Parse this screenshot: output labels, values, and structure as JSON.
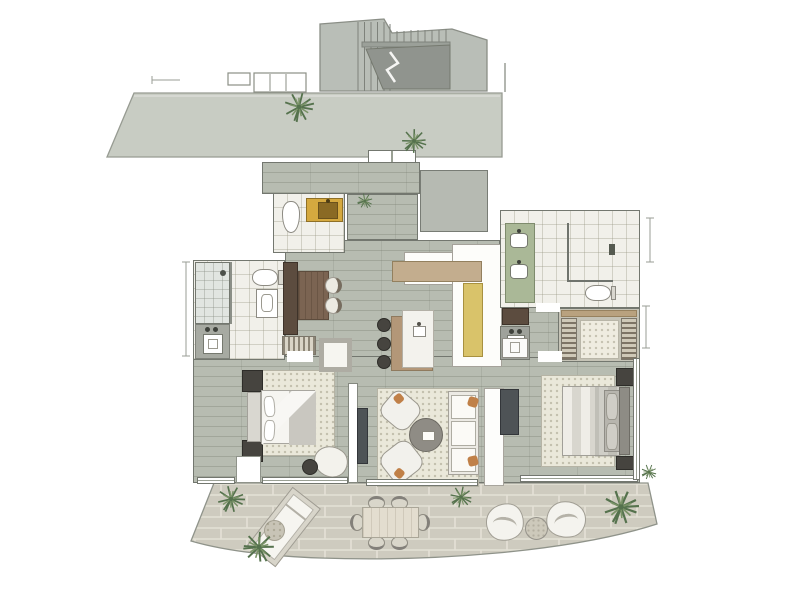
{
  "palette": {
    "bg": "#ffffff",
    "wall-line": "#73776f",
    "wood-floor": "#b7bcb1",
    "tile-floor": "#f1f0ea",
    "concrete": "#c8ccc3",
    "concrete-dark": "#90948e",
    "stair-light": "#b9beb7",
    "paver": "#cecbbf",
    "paver-joint": "#e4e1d6",
    "gray-room": "#b6bab2",
    "amber-counter": "#d5a93f",
    "amber-sink": "#8a6a24",
    "yellow-counter": "#d9c36a",
    "green-counter": "#aab897",
    "wood-bar": "#c3ad8e",
    "wood-dark": "#5c4c3f",
    "wood-table": "#7b6452",
    "island-wood": "#b39778",
    "marble": "#f3f2ed",
    "dark-furniture": "#46443f",
    "tv-dark": "#4e5356",
    "rug": "#eae8da",
    "bed-white": "#f6f5f1",
    "bed-gray": "#c9c7c0",
    "sofa-white": "#f2f1ec",
    "orange-accent": "#c08048",
    "plant-dark": "#55724d",
    "plant-light": "#7a9367",
    "glass-line": "#6f736d"
  },
  "plan": {
    "type": "apartment-floor-plan",
    "areas": [
      {
        "name": "staircase",
        "items": [
          "stairs",
          "ramp",
          "break-line"
        ]
      },
      {
        "name": "upper-walkway",
        "items": [
          "landing",
          "steps",
          "plant",
          "plant"
        ]
      },
      {
        "name": "entry-hall",
        "items": [
          "entry-step",
          "plant"
        ]
      },
      {
        "name": "powder-room",
        "items": [
          "toilet",
          "amber-vanity",
          "sink"
        ]
      },
      {
        "name": "storage-room",
        "items": []
      },
      {
        "name": "kitchen",
        "items": [
          "counter-bar",
          "yellow-counter",
          "island",
          "island-sink",
          "stool",
          "stool",
          "stool"
        ]
      },
      {
        "name": "dining-nook",
        "items": [
          "tall-cabinet",
          "wood-table",
          "chair",
          "chair"
        ]
      },
      {
        "name": "bathroom-2",
        "items": [
          "shower",
          "toilet",
          "wall-basin",
          "vanity-sink"
        ]
      },
      {
        "name": "hall-closet",
        "items": [
          "hanging-rack",
          "white-cabinet"
        ]
      },
      {
        "name": "master-bathroom",
        "items": [
          "double-vanity",
          "sink",
          "sink",
          "glass-shower",
          "toilet"
        ]
      },
      {
        "name": "walk-in-closet",
        "items": [
          "hanging-rack",
          "hanging-rack",
          "rug",
          "shelf"
        ]
      },
      {
        "name": "hall-vanity",
        "items": [
          "cabinet",
          "sink"
        ]
      },
      {
        "name": "bedroom-2",
        "items": [
          "bed",
          "headboard",
          "nightstand",
          "nightstand",
          "rug",
          "lounge-chair",
          "side-table",
          "tv-console",
          "terrace-door"
        ]
      },
      {
        "name": "living-room",
        "items": [
          "rug",
          "armchair",
          "armchair",
          "coffee-table",
          "sofa",
          "tv-console",
          "sideboard-wall"
        ]
      },
      {
        "name": "master-bedroom",
        "items": [
          "bed",
          "headboard",
          "pillows",
          "nightstand",
          "nightstand",
          "rug",
          "tv-console",
          "dresser"
        ]
      },
      {
        "name": "terrace",
        "items": [
          "sun-lounger",
          "side-table",
          "dining-table",
          "chair",
          "chair",
          "chair",
          "chair",
          "chair",
          "chair",
          "lounge-chair",
          "lounge-chair",
          "side-table",
          "plant",
          "plant",
          "plant",
          "plant",
          "plant"
        ]
      }
    ]
  }
}
